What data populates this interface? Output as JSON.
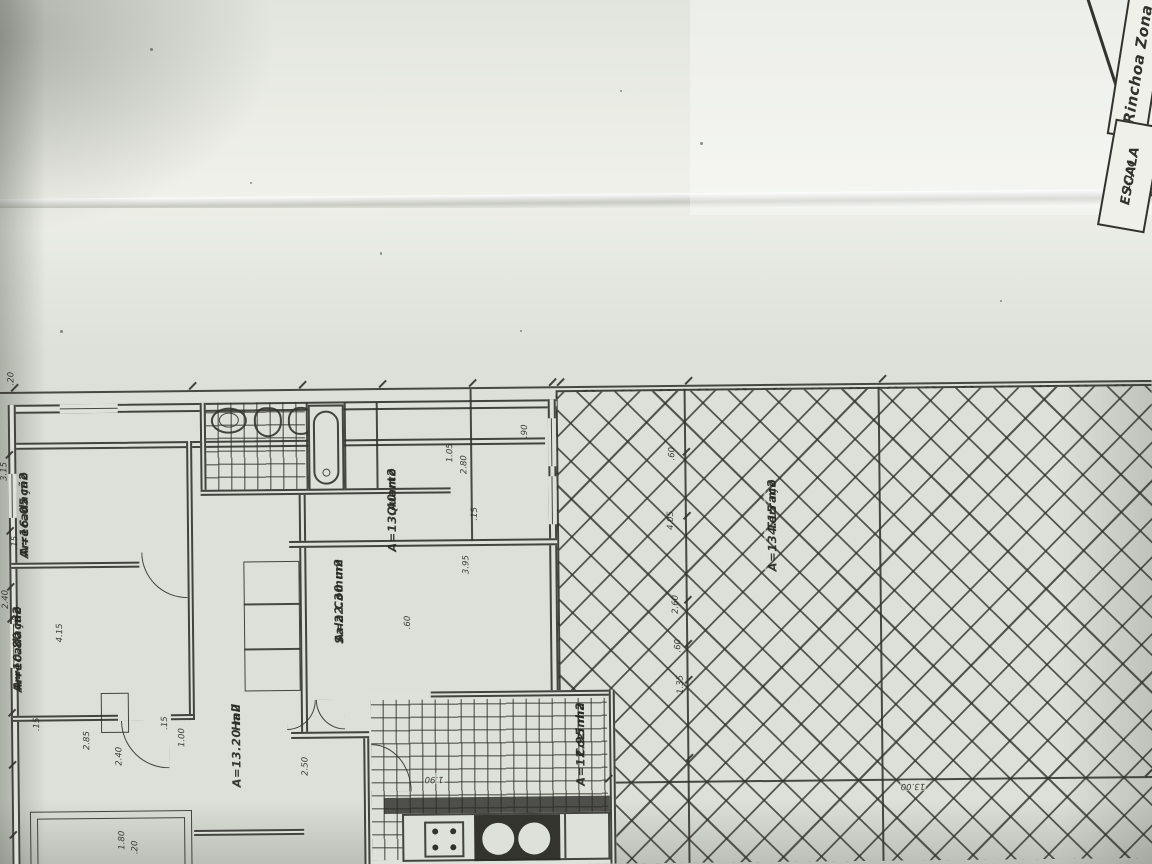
{
  "colors": {
    "paper": "#dce0d8",
    "paper_bright": "#f0f1eb",
    "ink": "#32322d"
  },
  "title_block": {
    "scale_label": "ESCALA",
    "scale_value": "1:100",
    "zone_label": "Rinchoa Zona"
  },
  "rooms": {
    "arrecadacao1": {
      "name": "Arrecadação",
      "area": "A=16.05 m2"
    },
    "arrecadacao2": {
      "name": "Arrecadação",
      "area": "A=10.80 m2"
    },
    "hall": {
      "name": "Hall",
      "area": "A=13.20 m2"
    },
    "sala_comum": {
      "name": "Sala Comum",
      "area": "A=22.30 m2"
    },
    "quarto": {
      "name": "Quarto",
      "area": "A=13.40 m2"
    },
    "cozinha": {
      "name": "Cozinha",
      "area": "A=12.95 m2"
    },
    "terraco": {
      "name": "Terraço",
      "area": "A=134.15 m2"
    }
  },
  "dimensions": [
    {
      "text": ".20",
      "x": 8,
      "y": 366,
      "rot": "v"
    },
    {
      "text": "3.15",
      "x": 0,
      "y": 456,
      "rot": "v"
    },
    {
      "text": ".15",
      "x": 10,
      "y": 530,
      "rot": "v"
    },
    {
      "text": "2.40",
      "x": 0,
      "y": 584,
      "rot": "v"
    },
    {
      "text": "4.15",
      "x": 54,
      "y": 618,
      "rot": "v"
    },
    {
      "text": ".15",
      "x": 30,
      "y": 712,
      "rot": "v"
    },
    {
      "text": "2.85",
      "x": 80,
      "y": 726,
      "rot": "v"
    },
    {
      "text": "2.40",
      "x": 112,
      "y": 742,
      "rot": "v"
    },
    {
      "text": "1.80",
      "x": 114,
      "y": 826,
      "rot": "v"
    },
    {
      "text": ".20",
      "x": 127,
      "y": 836,
      "rot": "v"
    },
    {
      "text": ".15",
      "x": 158,
      "y": 712,
      "rot": "v"
    },
    {
      "text": "1.00",
      "x": 175,
      "y": 724,
      "rot": "v"
    },
    {
      "text": "2.50",
      "x": 298,
      "y": 754,
      "rot": "v"
    },
    {
      "text": ".60",
      "x": 402,
      "y": 614,
      "rot": "v"
    },
    {
      "text": "1.05",
      "x": 446,
      "y": 442,
      "rot": "v"
    },
    {
      "text": "2.80",
      "x": 460,
      "y": 454,
      "rot": "v"
    },
    {
      "text": ".15",
      "x": 470,
      "y": 506,
      "rot": "v"
    },
    {
      "text": "3.95",
      "x": 461,
      "y": 554,
      "rot": "v"
    },
    {
      "text": ".90",
      "x": 521,
      "y": 424,
      "rot": "v"
    },
    {
      "text": ".60",
      "x": 668,
      "y": 448,
      "rot": "v"
    },
    {
      "text": "4.05",
      "x": 666,
      "y": 512,
      "rot": "v"
    },
    {
      "text": "2.60",
      "x": 670,
      "y": 596,
      "rot": "v"
    },
    {
      "text": ".60",
      "x": 672,
      "y": 640,
      "rot": "v"
    },
    {
      "text": "1.35",
      "x": 674,
      "y": 676,
      "rot": "v"
    },
    {
      "text": "1.90",
      "x": 420,
      "y": 772,
      "rot": "h"
    },
    {
      "text": "13.00",
      "x": 896,
      "y": 784,
      "rot": "h"
    }
  ]
}
